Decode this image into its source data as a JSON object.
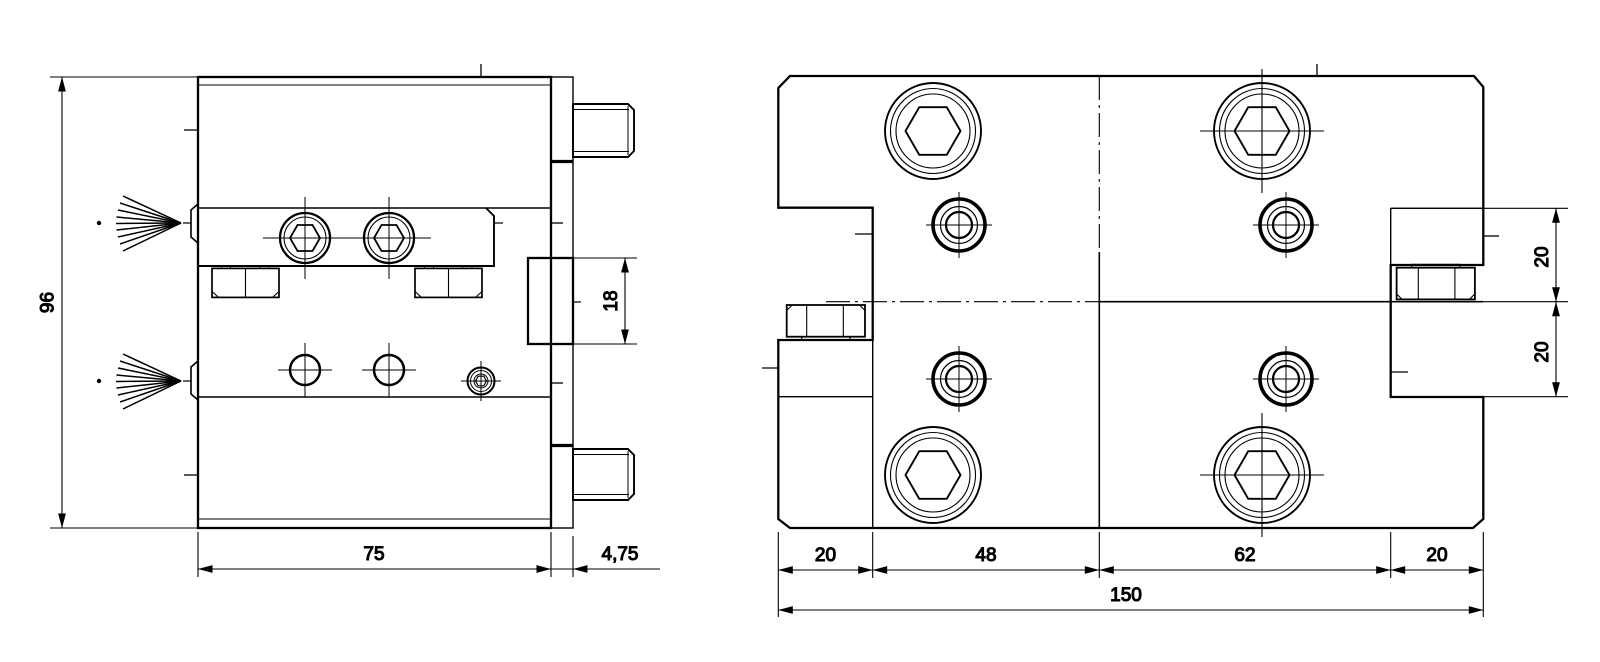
{
  "drawing": {
    "kind": "technical-dimension-drawing",
    "units": "mm",
    "line_color": "#000000",
    "background": "#ffffff",
    "views": {
      "front": {
        "label": "front-view",
        "dims": {
          "height": "96",
          "body_width": "75",
          "flange_thickness": "4,75",
          "sensor_slot_height": "18"
        },
        "features": [
          "threaded-stud-top",
          "threaded-stud-bottom",
          "exhaust-spray-top",
          "exhaust-spray-bottom",
          "socket-screw-pair",
          "hex-nut-pair",
          "through-hole-pair",
          "small-socket-screw",
          "sensor-slot-block"
        ]
      },
      "plan": {
        "label": "plan-view",
        "dims": {
          "left_flange_width": "20",
          "left_bolt_span": "48",
          "right_bolt_span": "62",
          "right_flange_width": "20",
          "overall_length": "150",
          "upper_section_height": "20",
          "lower_section_height": "20"
        },
        "features": [
          "hex-socket-bolt-x4",
          "port-screw-x4",
          "hex-nut-left",
          "hex-nut-right",
          "center-line-vertical",
          "center-line-horizontal"
        ]
      }
    }
  }
}
